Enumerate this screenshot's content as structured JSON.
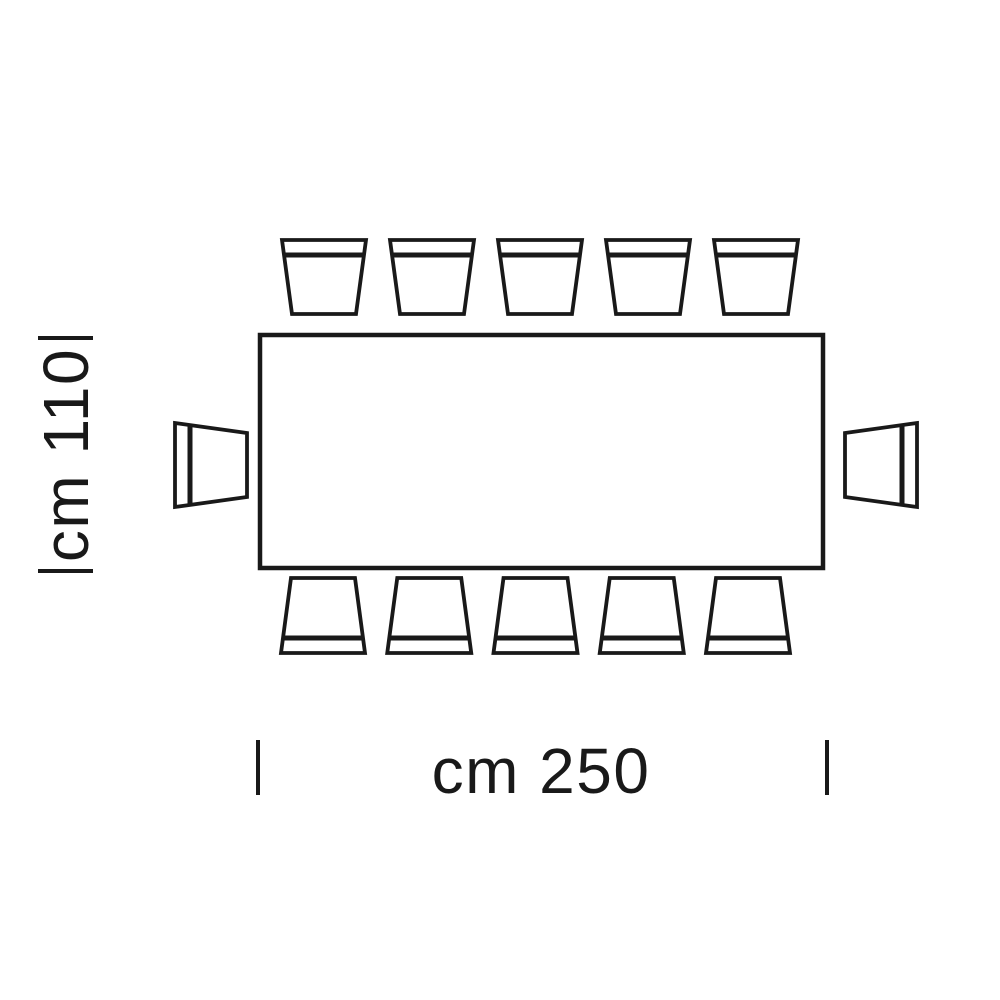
{
  "diagram": {
    "dimensions": {
      "width": {
        "label": "cm 250",
        "value": 250,
        "unit": "cm"
      },
      "depth": {
        "label": "cm 110",
        "value": 110,
        "unit": "cm"
      }
    },
    "seating": {
      "top": 5,
      "bottom": 5,
      "left": 1,
      "right": 1,
      "total": 12
    },
    "colors": {
      "line": "#191919",
      "background": "#ffffff"
    }
  }
}
